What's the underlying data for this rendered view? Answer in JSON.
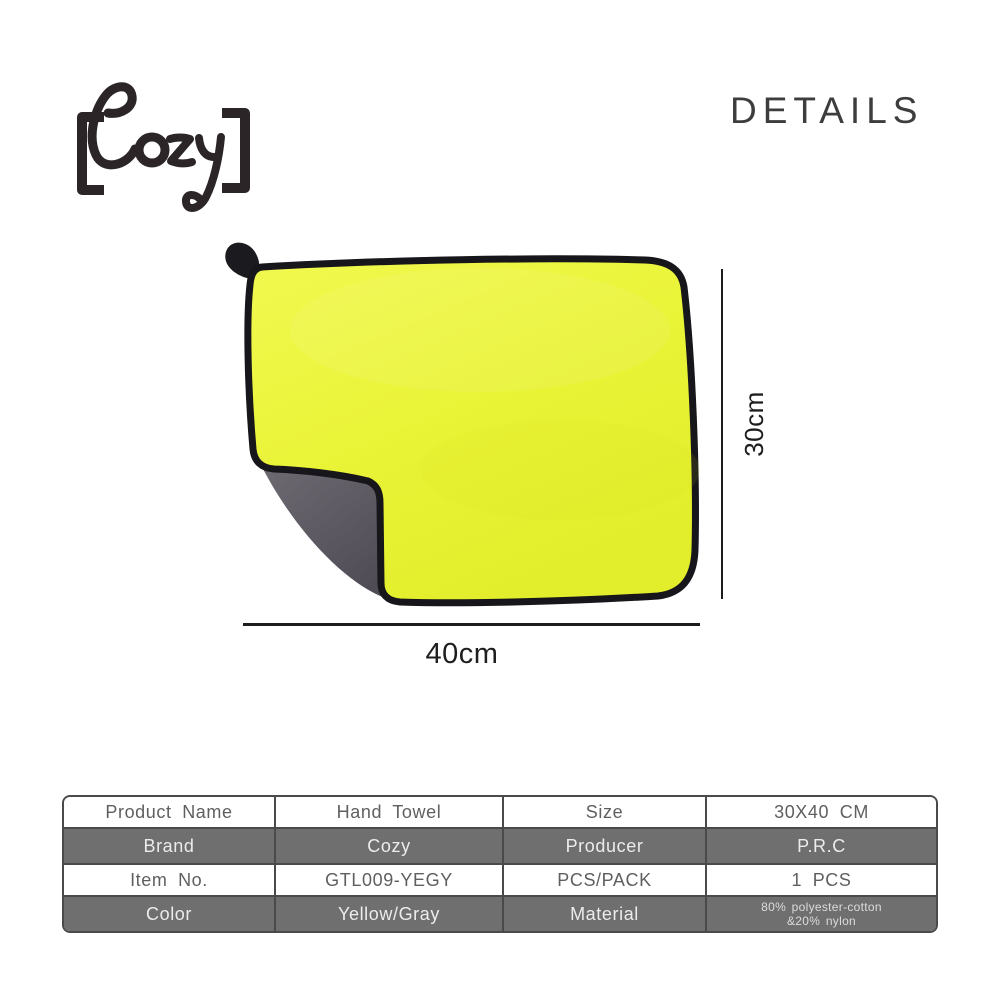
{
  "brand": {
    "logo_text": "[Cozy]"
  },
  "header": {
    "title": "DETAILS"
  },
  "product_figure": {
    "description": "Yellow microfiber hand towel with gray reverse side, black edge binding and a corner hanging loop, bottom-left corner folded over",
    "height_label": "30cm",
    "width_label": "40cm",
    "colors": {
      "towel_front": "#eaf438",
      "towel_back": "#5b5861",
      "edge_binding": "#1a181c"
    }
  },
  "spec_table": {
    "grid_color": "#4a4a4a",
    "dark_row_bg": "#6f6f6f",
    "rows": [
      {
        "label1": "Product Name",
        "value1": "Hand Towel",
        "label2": "Size",
        "value2": "30X40 CM"
      },
      {
        "label1": "Brand",
        "value1": "Cozy",
        "label2": "Producer",
        "value2": "P.R.C"
      },
      {
        "label1": "Item No.",
        "value1": "GTL009-YEGY",
        "label2": "PCS/PACK",
        "value2": "1 PCS"
      },
      {
        "label1": "Color",
        "value1": "Yellow/Gray",
        "label2": "Material",
        "value2_line1": "80% polyester-cotton",
        "value2_line2": "&20% nylon"
      }
    ]
  }
}
